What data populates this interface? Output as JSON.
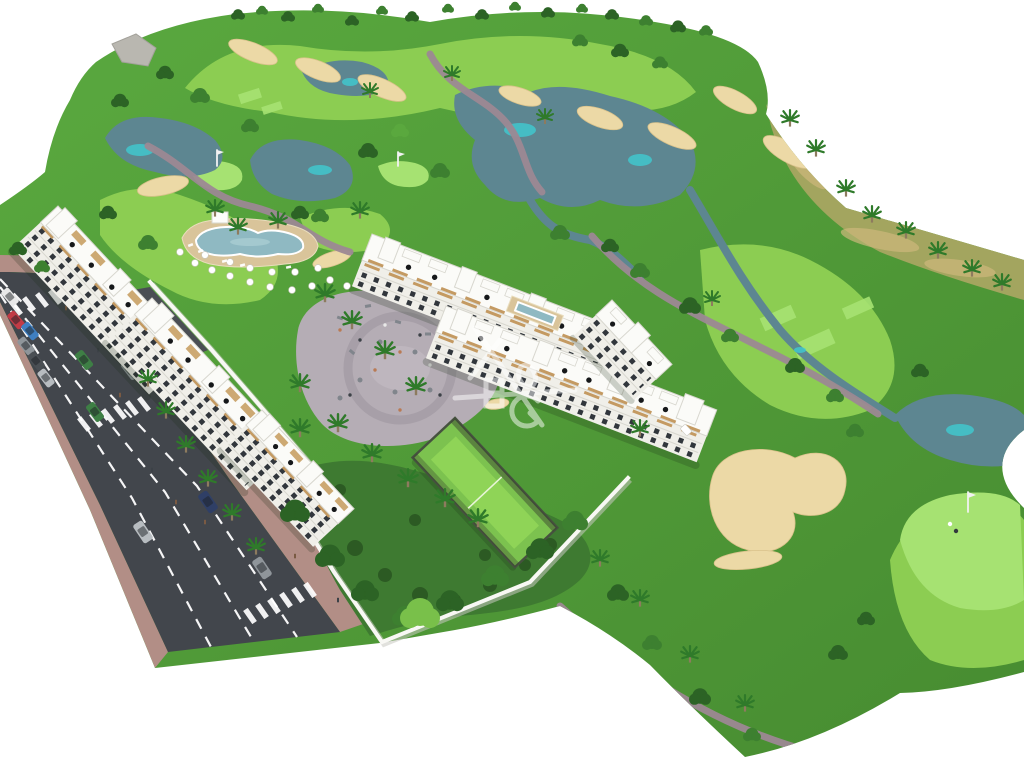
{
  "scene": {
    "description": "Aerial 3D architectural render of a white apartment resort complex with lagoon pool, umbrella terrace, playground plaza, paddle tennis court and gardens, set beside a golf course with lakes, sand bunkers, winding cart paths, palm trees and a road with parked cars; white background canvas with a semi-transparent logo watermark in the center",
    "watermark": "semi-transparent line-art developer logo",
    "image_width": 1024,
    "image_height": 760
  },
  "colors": {
    "bg": "#ffffff",
    "rough1": "#58a73e",
    "rough2": "#478c31",
    "fairway": "#8ccd52",
    "green": "#a6e272",
    "scrub": "#a3a55f",
    "scrubTan": "#cdb87c",
    "lake": "#5d8691",
    "lakeHl": "#3ecfd6",
    "sand": "#ecd9a6",
    "sandEdge": "#d9c28b",
    "asphalt": "#42464c",
    "asphaltLight": "#4a4e54",
    "sidewalk": "#b28e86",
    "lane": "#ffffff",
    "path": "#9c8894",
    "wallWhite": "#f8f8f4",
    "wallShadow": "#c9c9c1",
    "facade": "#f0efe9",
    "roof": "#fbfbf8",
    "roofEdge": "#d8d7cf",
    "window": "#31363c",
    "wood": "#c49a62",
    "pergola": "#c9a267",
    "umbrellaBlack": "#16181a",
    "umbrellaWhite": "#ffffff",
    "poolDeck": "#d9c49a",
    "poolWater": "#8fb9c2",
    "poolRim": "#ffffff",
    "plaza": "#b5adb5",
    "plazaIn": "#beb6be",
    "plazaPath": "#a59da6",
    "equipment": "#80858c",
    "court": "#7cc24f",
    "courtInner": "#8fd457",
    "courtFence": "#46523f",
    "garden": "#3e7a31",
    "bush": "#2c5a23",
    "rock": "#b9b7b0",
    "treeDark": "#2c6325",
    "treeMid": "#3d8030",
    "treeLight": "#5aa83e",
    "treeBright": "#79c04a",
    "palm": "#2f7a2a",
    "trunk": "#8d7b5e",
    "flagPole": "#f2f2f2",
    "pedestrian": "#7a5a43",
    "pedestrian2": "#3c4147",
    "watermark": "#ffffff",
    "car_red": "#c23b46",
    "car_blue": "#3f7fc1",
    "car_white": "#e8e8e8",
    "car_grey": "#8f959a",
    "car_silver": "#b7bcc0",
    "car_dark": "#4a4f54",
    "car_green": "#3e7f45",
    "car_navy": "#2f3f66"
  },
  "objects": {
    "road": {
      "crosswalks": 3,
      "dashed_lane_lines": 3,
      "cars": 14
    },
    "golf_course": {
      "flags": 3,
      "lakes": 6,
      "sand_bunkers": 13,
      "putting_greens": 3
    },
    "buildings": {
      "apartment_blocks": 6
    },
    "amenities": [
      "lagoon-pool",
      "pool-terrace-umbrellas",
      "playground-plaza",
      "paddle-court",
      "gardens"
    ]
  }
}
